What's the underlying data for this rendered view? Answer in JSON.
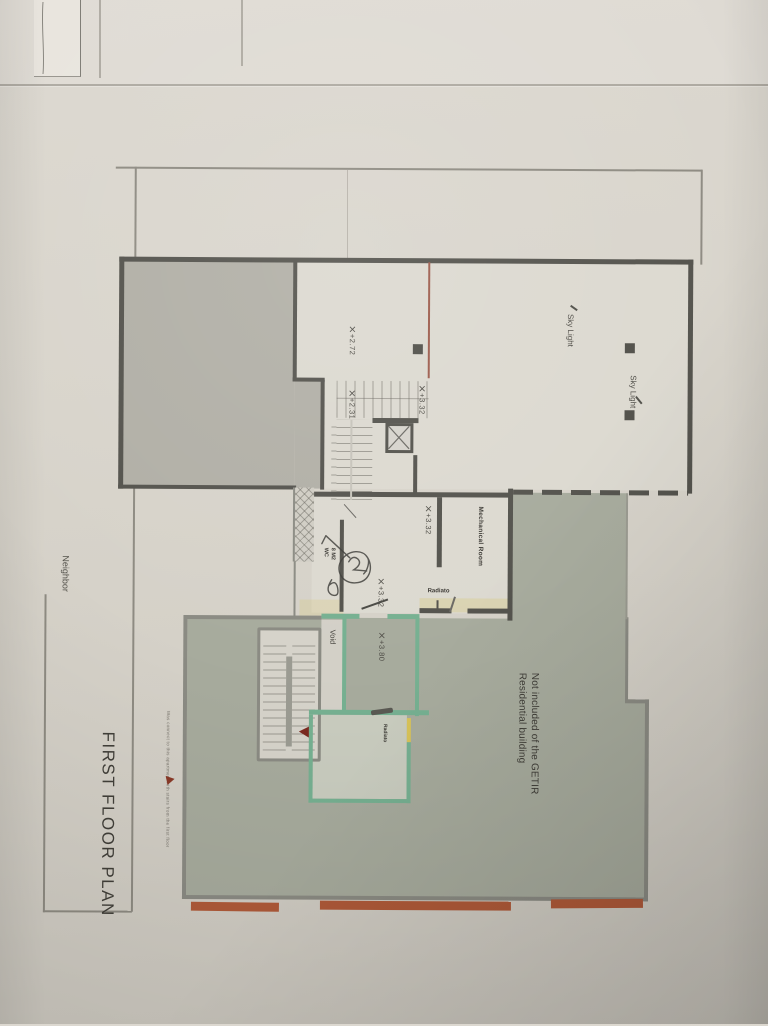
{
  "title_block": {
    "title": "FIRST FLOOR PLAN"
  },
  "labels": {
    "neighbor": "Neighbor",
    "void": "Void",
    "mechanical_room": "Mechanical Room",
    "radiator_mech": "Radiato",
    "radiator_room": "Radiato",
    "wc_line1": "WC",
    "wc_line2": "8 M2",
    "sky_light_left": "Sky Light",
    "sky_light_right": "Sky Light",
    "residential_line1": "Residential building",
    "residential_line2": "Not included of the GETIR",
    "annotation": "Was connect to this apartment with stairs from the first floor"
  },
  "levels": {
    "upper_room": "+2.72",
    "landing": "+2.31",
    "stair_top": "+3.32",
    "hall_west": "+3.32",
    "hall_south": "+3.32",
    "void_room": "+3.80"
  },
  "colors": {
    "paper": "#d8d4cb",
    "dark_wall": "#54534d",
    "gray_fill": "#b1afa6",
    "green_fill": "#a7ab9d",
    "green_wall": "#76b091",
    "outline_gray": "#8b8b83",
    "orange_strip": "#b05a39",
    "arrow_red": "#7c2a20",
    "door_yellow": "#d8c35a"
  }
}
